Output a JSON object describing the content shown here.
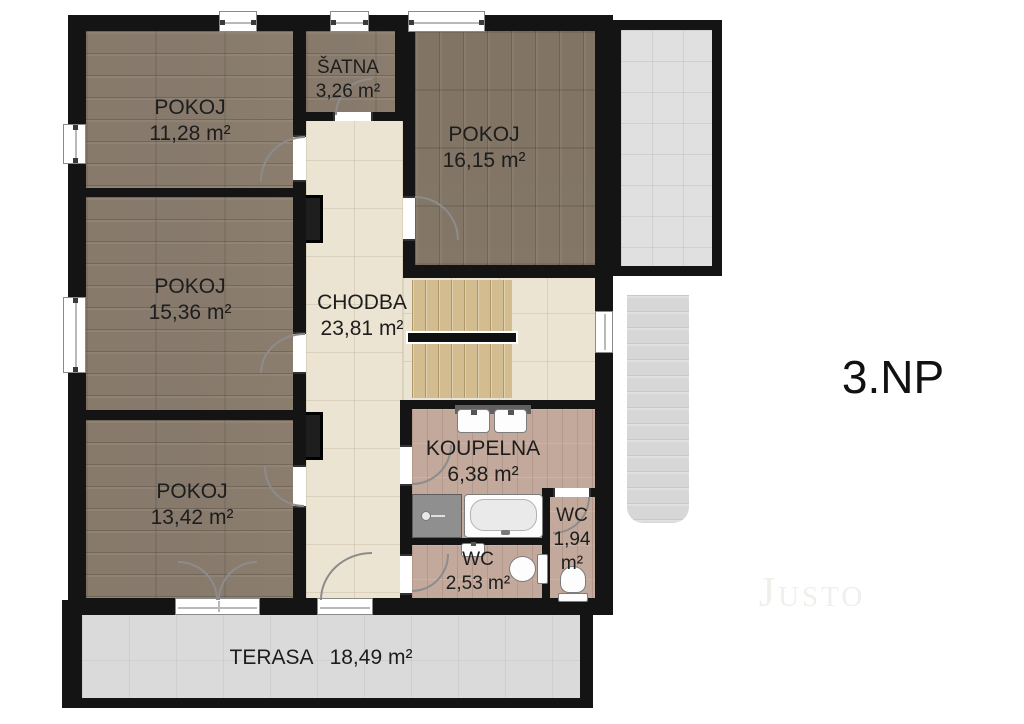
{
  "floor_label": "3.NP",
  "watermark": "Justo",
  "rooms": {
    "pokoj_top_left": {
      "name": "POKOJ",
      "area": "11,28 m²"
    },
    "satna": {
      "name": "ŠATNA",
      "area": "3,26 m²"
    },
    "pokoj_top_right": {
      "name": "POKOJ",
      "area": "16,15 m²"
    },
    "pokoj_mid_left": {
      "name": "POKOJ",
      "area": "15,36 m²"
    },
    "chodba": {
      "name": "CHODBA",
      "area": "23,81 m²"
    },
    "pokoj_bottom_left": {
      "name": "POKOJ",
      "area": "13,42 m²"
    },
    "koupelna": {
      "name": "KOUPELNA",
      "area": "6,38 m²"
    },
    "wc_small": {
      "name": "WC",
      "area": "1,94",
      "unit": "m²"
    },
    "wc_large": {
      "name": "WC",
      "area": "2,53 m²"
    },
    "terasa": {
      "name": "TERASA",
      "area": "18,49 m²"
    }
  }
}
